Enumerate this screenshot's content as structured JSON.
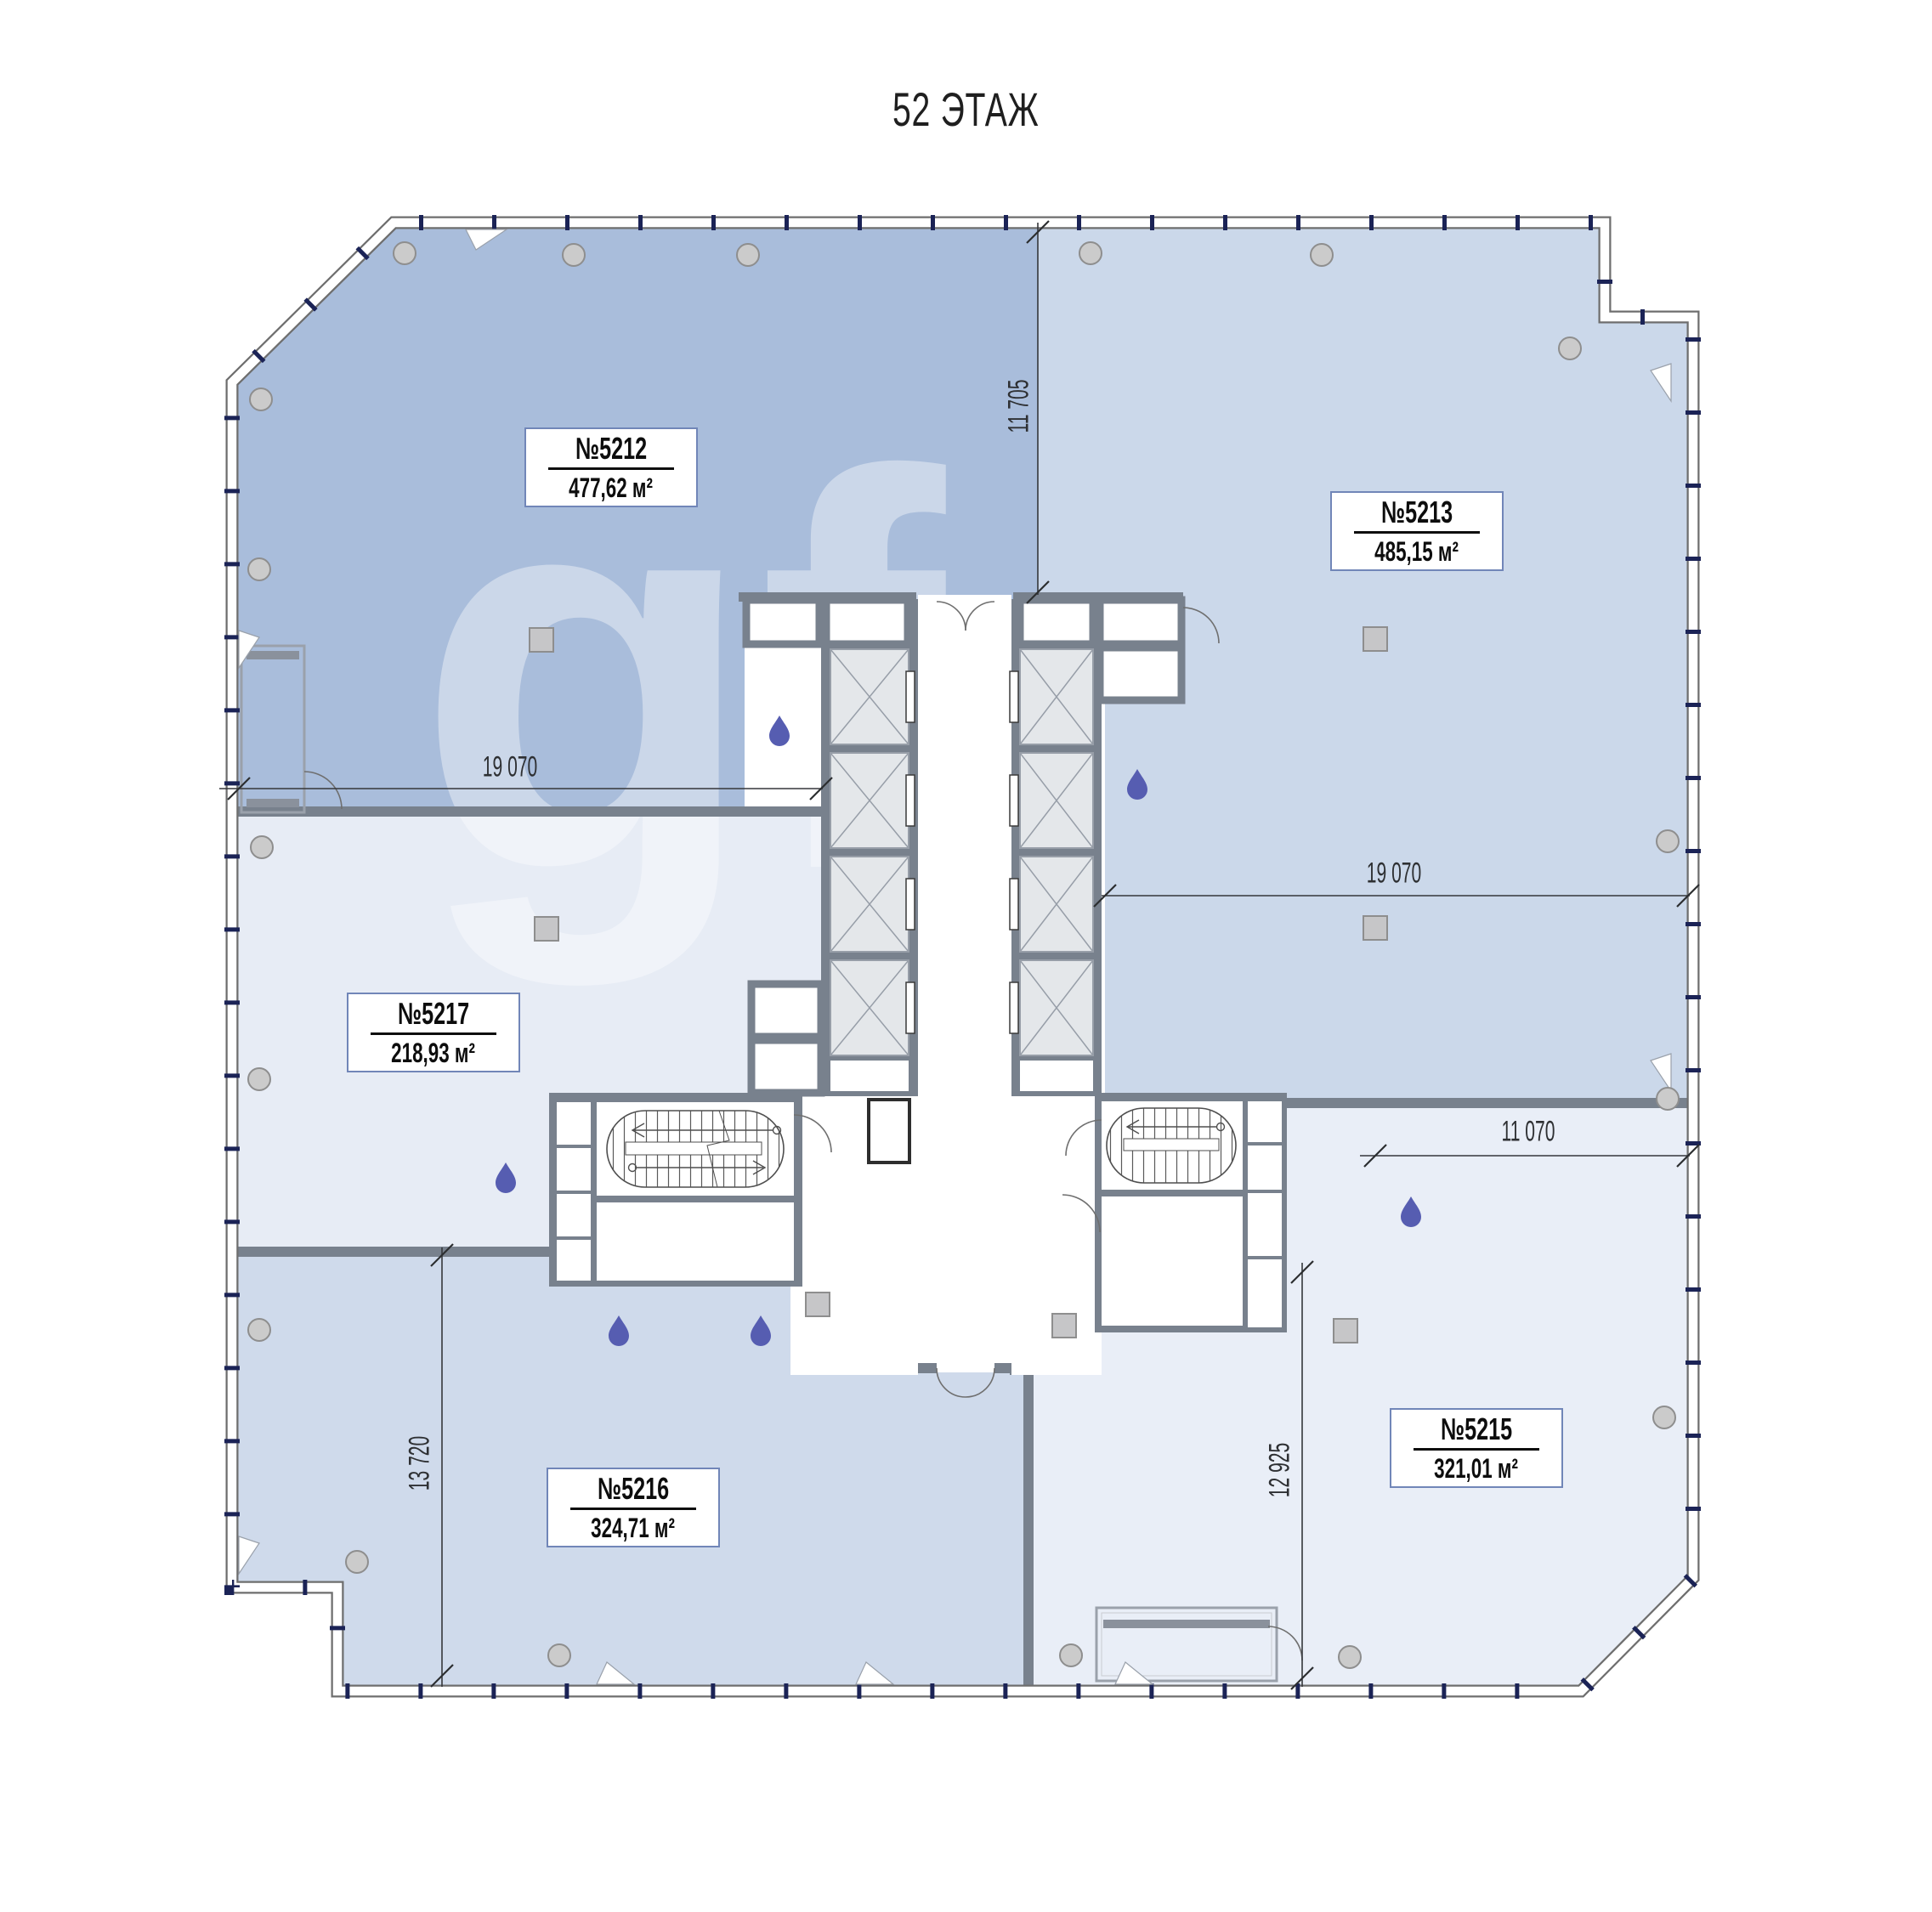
{
  "title": "52 ЭТАЖ",
  "watermark": "gf",
  "units": [
    {
      "id": "5212",
      "number": "№5212",
      "area": "477,62 м²"
    },
    {
      "id": "5213",
      "number": "№5213",
      "area": "485,15 м²"
    },
    {
      "id": "5217",
      "number": "№5217",
      "area": "218,93 м²"
    },
    {
      "id": "5216",
      "number": "№5216",
      "area": "324,71 м²"
    },
    {
      "id": "5215",
      "number": "№5215",
      "area": "321,01 м²"
    }
  ],
  "dimensions": {
    "top_vertical": "11 705",
    "left_horizontal": "19 070",
    "right_horizontal": "19 070",
    "right_lower_horizontal": "11 070",
    "left_vertical": "13 720",
    "right_vertical": "12 925"
  },
  "icons": {
    "water_drop": "teardrop-shape",
    "column_round": "circle-shape",
    "column_square": "square-shape"
  },
  "colors": {
    "room_5212": "#a9bddb",
    "room_5213": "#cbd8ea",
    "room_5217": "#e7ecf5",
    "room_5216": "#cfdaeb",
    "room_5215": "#e9eef7",
    "core_wall": "#78818d",
    "window_mullion": "#1b2356",
    "water_drop": "#565db1",
    "column_fill": "#cbcbcb",
    "label_border": "#7186b8",
    "dimension_line": "#35373b"
  }
}
